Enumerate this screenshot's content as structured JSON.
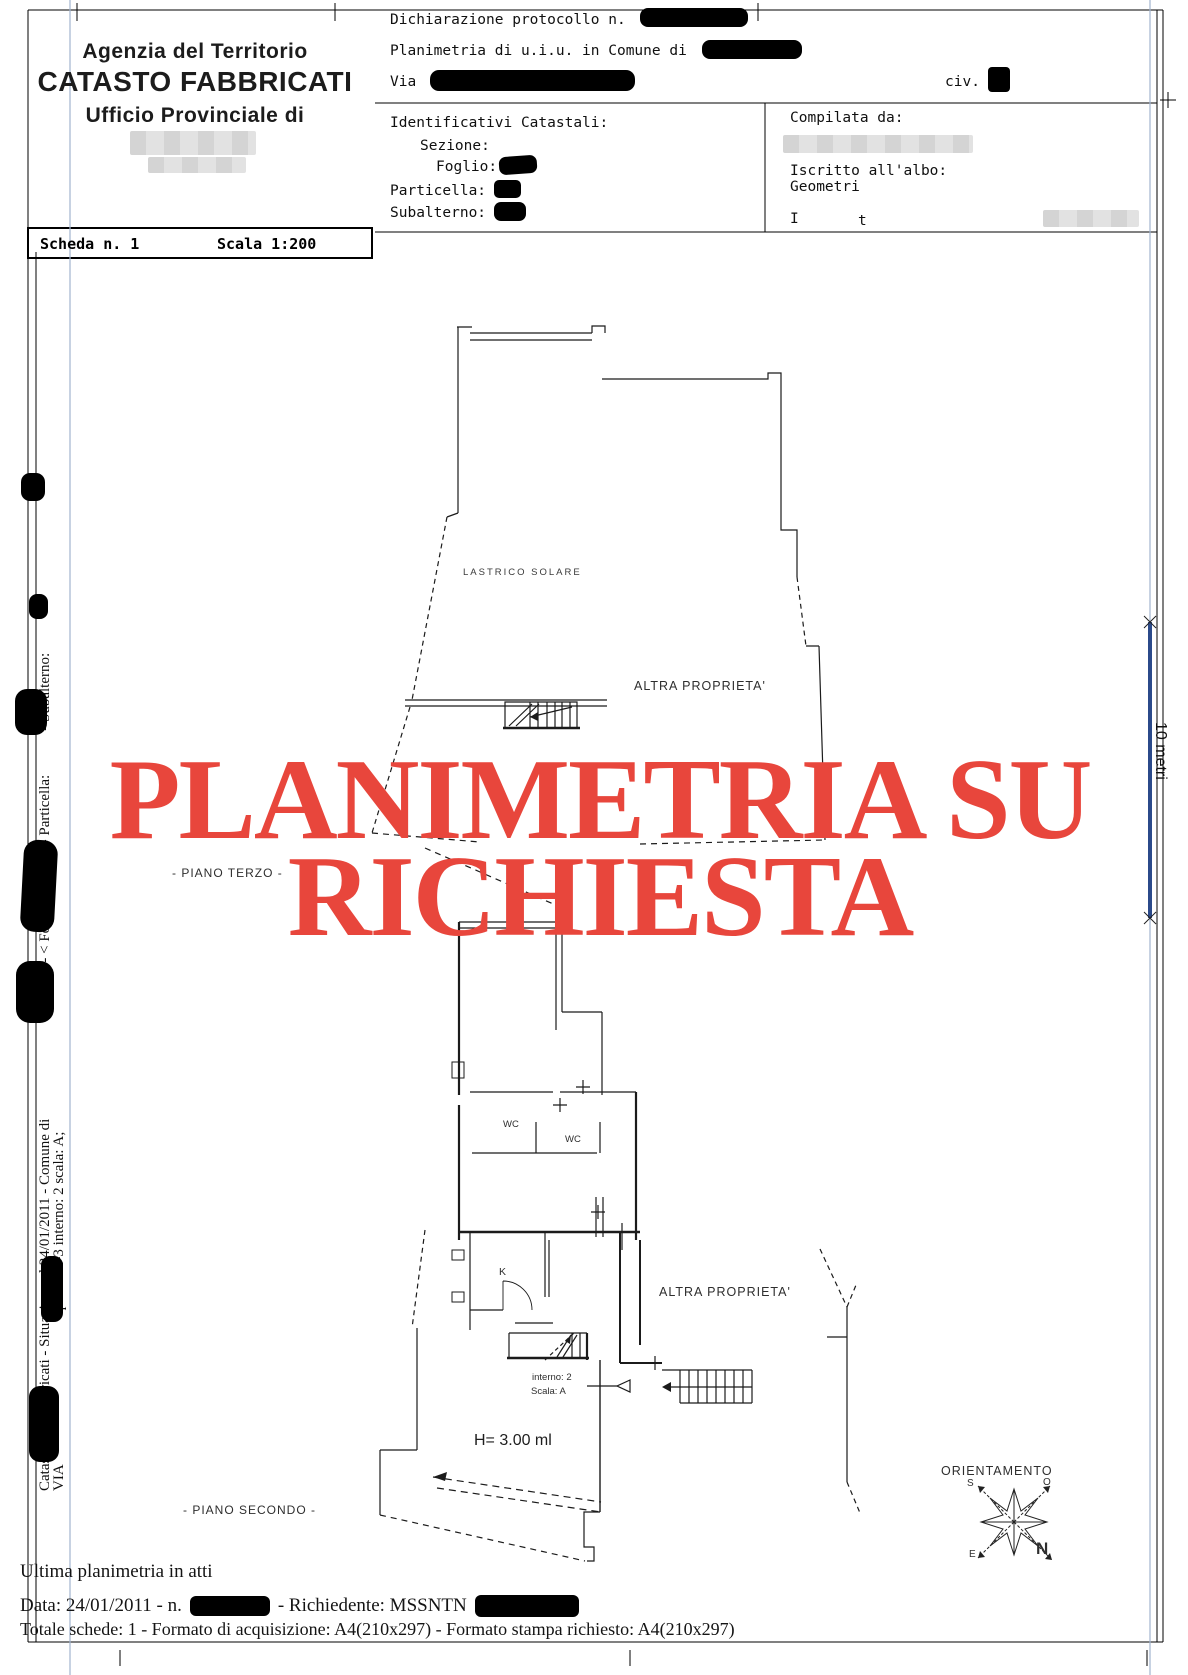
{
  "header_left": {
    "line1": "Agenzia del Territorio",
    "line2": "CATASTO FABBRICATI",
    "line3": "Ufficio Provinciale di"
  },
  "scheda": {
    "number_label": "Scheda n. 1",
    "scale_label": "Scala 1:200"
  },
  "declaration": {
    "protocol_label": "Dichiarazione protocollo n.",
    "planimetria_label": "Planimetria di u.i.u. in Comune di",
    "via_label": "Via",
    "civ_label": "civ."
  },
  "identificativi": {
    "title": "Identificativi Catastali:",
    "sezione": "Sezione:",
    "foglio": "Foglio:",
    "particella": "Particella:",
    "subalterno": "Subalterno:"
  },
  "compilata": {
    "title": "Compilata da:",
    "albo_label": "Iscritto all'albo:",
    "albo_value": "Geometri",
    "partial_left": "I",
    "partial_right": "t"
  },
  "sidebar": {
    "line1_part1": "Catasto dei Fabbricati - Situazione al 24/01/2011 - Comune di",
    "line1_part2": "(A271) - < Foglio:",
    "line1_part3": "- Particella:",
    "line1_part4": "- Subalterno:",
    "line1_part5": ">",
    "line2_part1": "VIA",
    "line2_part2": "piano: 2-3 interno: 2 scala: A;"
  },
  "plan": {
    "watermark_line1": "PLANIMETRIA SU",
    "watermark_line2": "RICHIESTA",
    "lastrico_label": "LASTRICO SOLARE",
    "altra_upper": "ALTRA PROPRIETA'",
    "altra_lower": "ALTRA PROPRIETA'",
    "piano_terzo": "- PIANO TERZO -",
    "piano_secondo": "- PIANO SECONDO -",
    "wc1": "WC",
    "wc2": "WC",
    "kitchen": "K",
    "interno_label": "interno: 2",
    "scala_label": "Scala: A",
    "height_label": "H= 3.00 ml"
  },
  "orientation": {
    "title": "ORIENTAMENTO",
    "north": "N",
    "south": "S",
    "east": "E",
    "west": "O"
  },
  "scalebar": {
    "label": "10 metri"
  },
  "footer": {
    "ultima": "Ultima planimetria in atti",
    "data_prefix": "Data: 24/01/2011 - n.",
    "data_middle": "- Richiedente: MSSNTN",
    "totale": "Totale schede: 1 - Formato di acquisizione: A4(210x297)  - Formato stampa richiesto: A4(210x297)"
  },
  "colors": {
    "watermark_red": "#e8463c",
    "scalebar_blue": "#2b4a8a",
    "fold_blue": "#a2b4cf",
    "ink": "#1b1b1b"
  }
}
